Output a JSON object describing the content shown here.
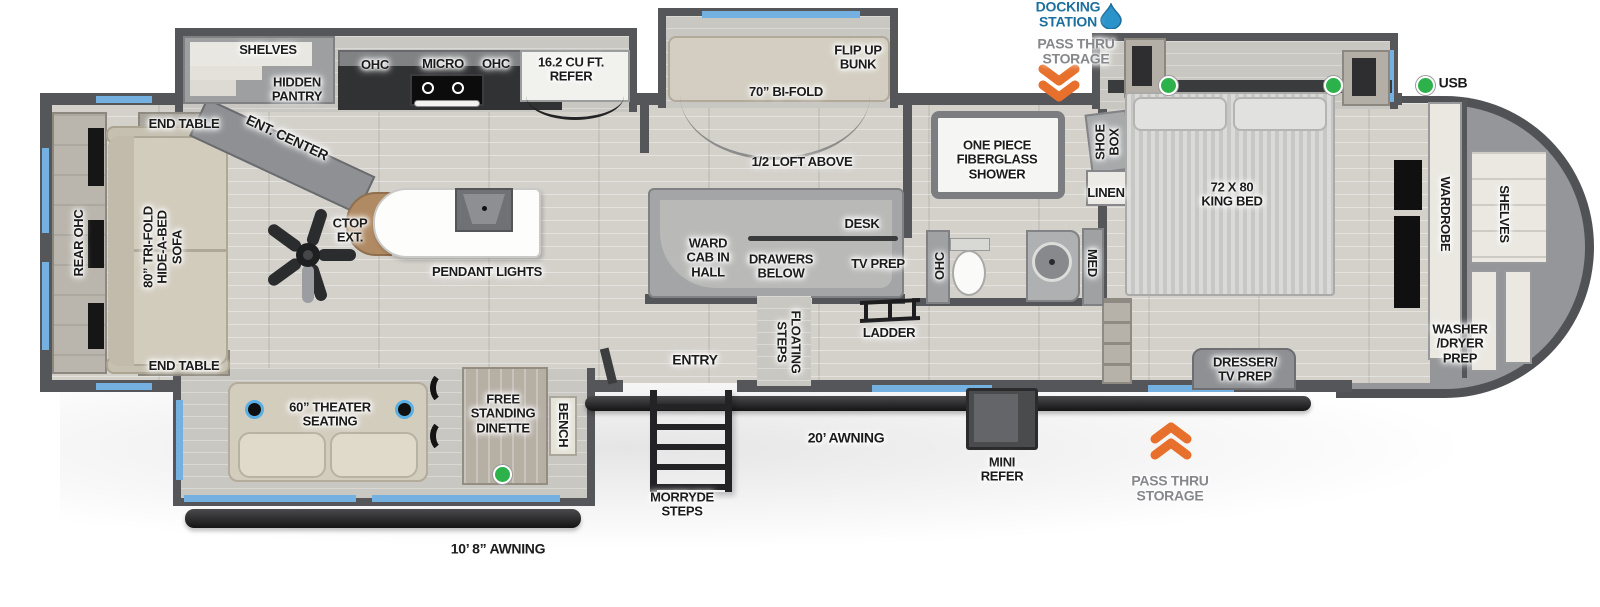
{
  "colors": {
    "wall": "#55565a",
    "window_blue": "#74b0e0",
    "chevron_orange": "#e8702d",
    "usb_green": "#2db24b",
    "docking_blue": "#1b6f9e",
    "floor_wood": "#d4d1cb",
    "awning_black": "#1c1c1e"
  },
  "legend": {
    "usb": "USB"
  },
  "exterior_top": {
    "docking_station": "DOCKING\nSTATION",
    "pass_thru": "PASS THRU\nSTORAGE"
  },
  "exterior_bottom": {
    "morryde_steps": "MORRYDE\nSTEPS",
    "awning_20": "20’ AWNING",
    "awning_10_8": "10’ 8” AWNING",
    "mini_refer": "MINI\nREFER",
    "pass_thru": "PASS THRU\nSTORAGE"
  },
  "living": {
    "rear_ohc": "REAR OHC",
    "end_table_top": "END TABLE",
    "end_table_bottom": "END TABLE",
    "sofa": "80” TRI-FOLD\nHIDE-A-BED\nSOFA",
    "ent_center": "ENT. CENTER",
    "theater_seating": "60” THEATER\nSEATING",
    "dinette": "FREE\nSTANDING\nDINETTE",
    "bench": "BENCH"
  },
  "kitchen": {
    "shelves": "SHELVES",
    "hidden_pantry": "HIDDEN\nPANTRY",
    "ohc_left": "OHC",
    "micro": "MICRO",
    "ohc_right": "OHC",
    "refer": "16.2 CU FT.\nREFER",
    "ctop_ext": "CTOP\nEXT.",
    "pendant_lights": "PENDANT LIGHTS"
  },
  "loft": {
    "flip_up_bunk": "FLIP UP\nBUNK",
    "bifold": "70” BI-FOLD",
    "half_loft": "1/2 LOFT ABOVE",
    "ward_cab": "WARD\nCAB IN\nHALL",
    "drawers_below": "DRAWERS\nBELOW",
    "desk": "DESK",
    "tv_prep": "TV PREP",
    "floating_steps": "FLOATING\nSTEPS",
    "ladder": "LADDER",
    "entry": "ENTRY"
  },
  "bathroom": {
    "shower": "ONE PIECE\nFIBERGLASS\nSHOWER",
    "shoe_box": "SHOE\nBOX",
    "linen": "LINEN",
    "ohc": "OHC",
    "med": "MED"
  },
  "bedroom": {
    "king_bed": "72 X 80\nKING BED",
    "dresser_tv": "DRESSER/\nTV PREP"
  },
  "front_cap": {
    "wardrobe": "WARDROBE",
    "shelves": "SHELVES",
    "washer_dryer": "WASHER\n/DRYER\nPREP"
  }
}
